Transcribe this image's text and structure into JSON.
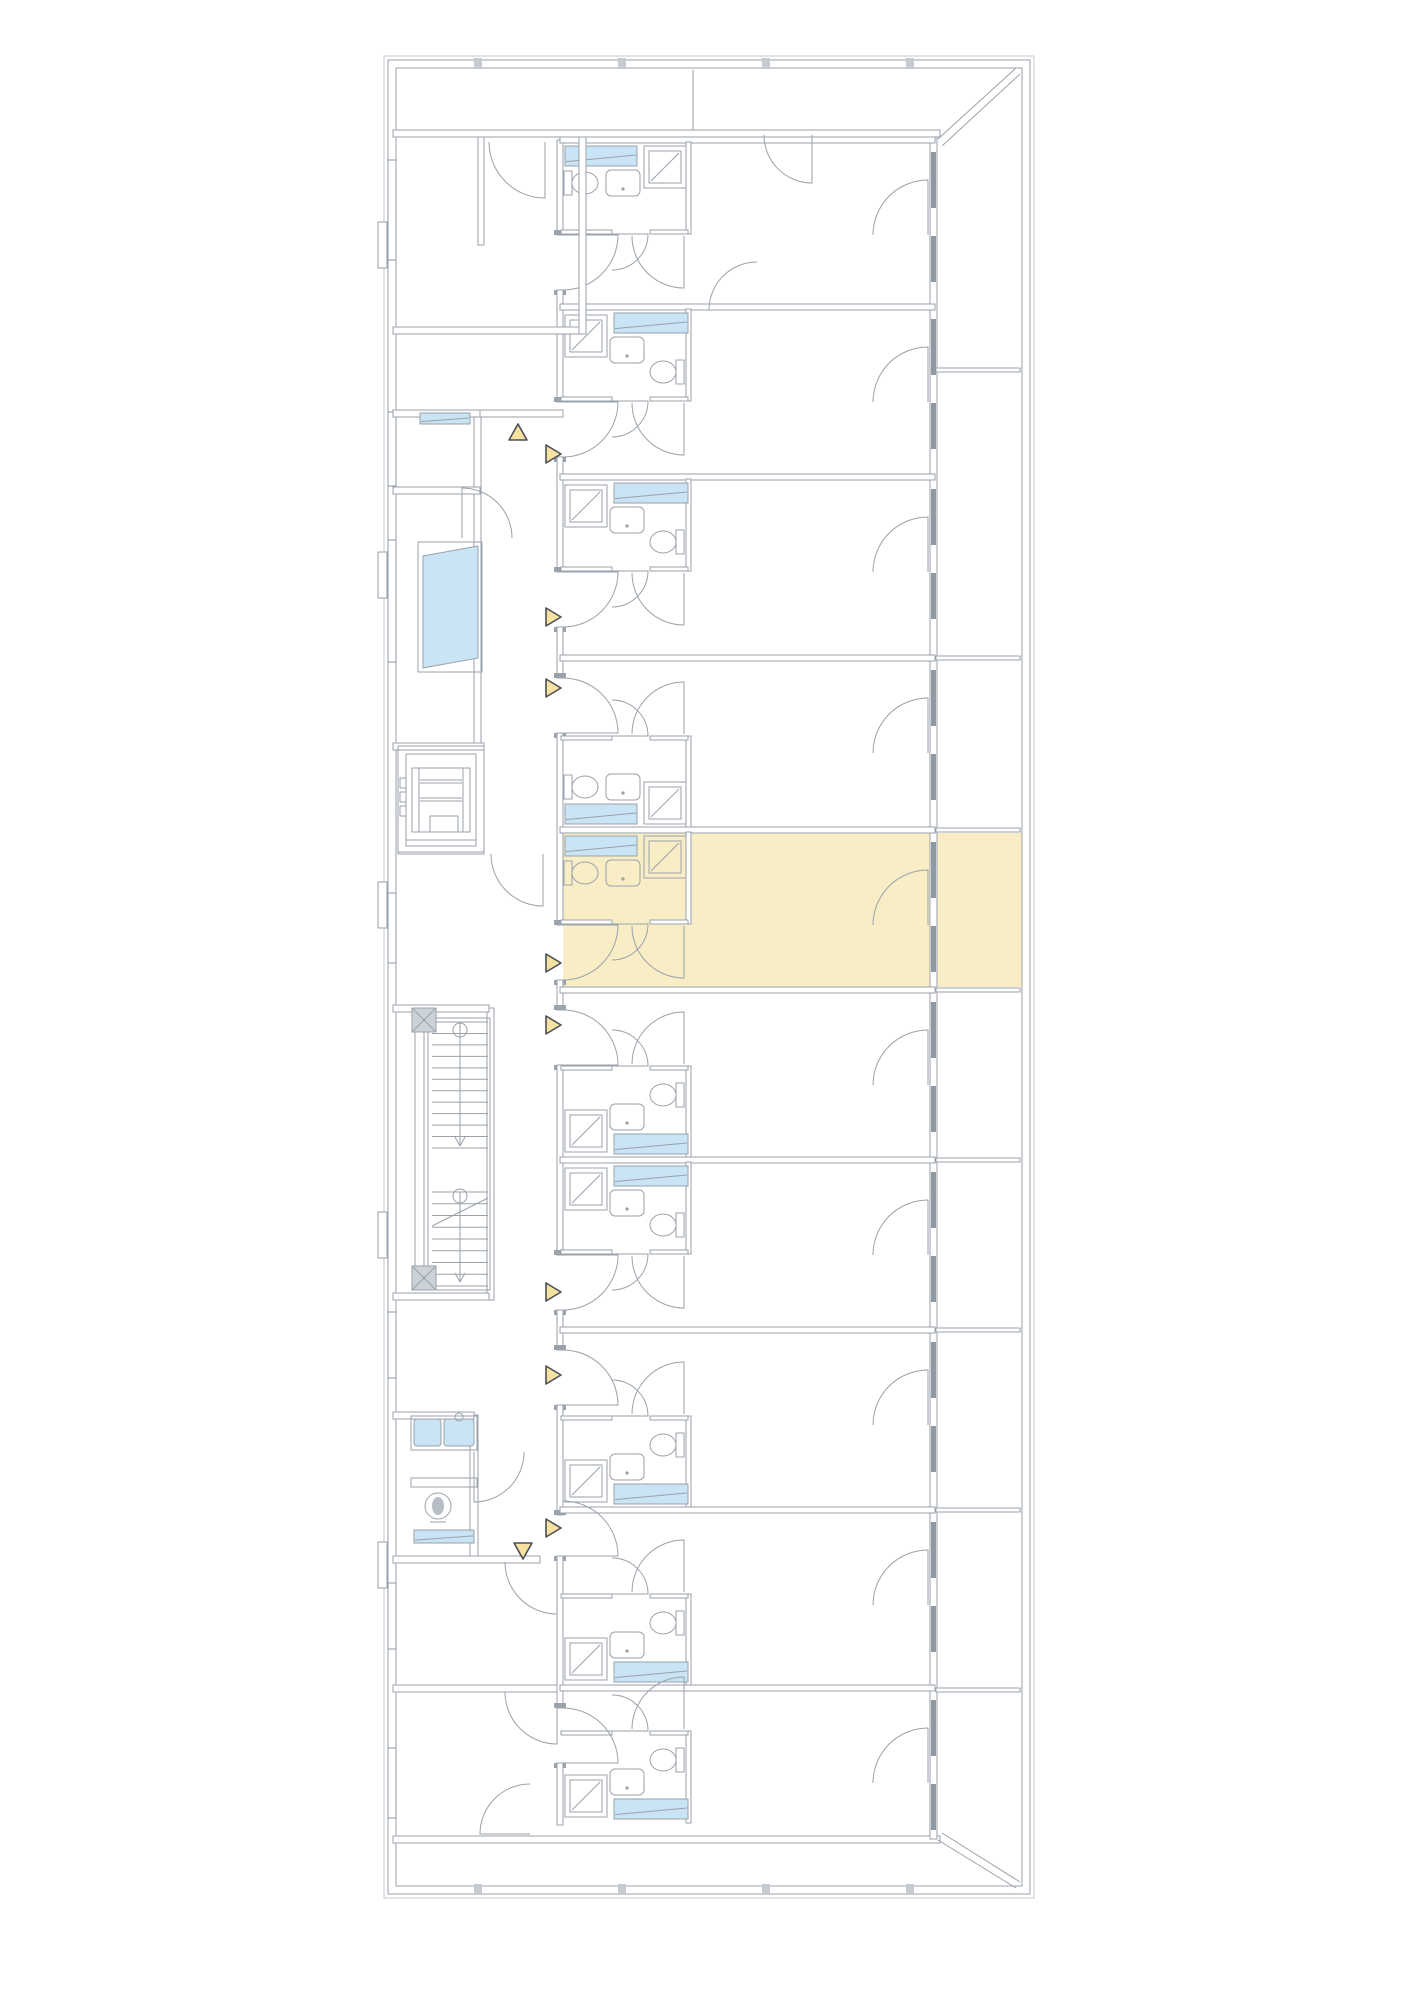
{
  "app": {
    "title": "floor-plan"
  },
  "palette": {
    "line": "#9aa2ab",
    "line_light": "#c6cbd1",
    "glazing": "#8f99a4",
    "highlight_fill": "#f9edc6",
    "water_blue": "#c9e4f4",
    "marker_fill": "#f5e1a0",
    "marker_stroke": "#4b4f57",
    "hatch_fill": "#cdd2d8",
    "background": "#ffffff"
  },
  "plan": {
    "width": 1414,
    "height": 2000,
    "shell": {
      "outer2": [
        384,
        56,
        650,
        1842
      ],
      "outer": [
        388,
        60,
        642,
        1834
      ],
      "inner": [
        396,
        68,
        626,
        1818
      ]
    },
    "bands": {
      "top_wall": [
        393,
        130,
        547,
        7
      ],
      "bottom_wall": [
        393,
        1836,
        547,
        7
      ],
      "right_wall": [
        930,
        137,
        7,
        1702
      ],
      "diag_tr": [
        [
          938,
          139,
          1016,
          68
        ],
        [
          942,
          146,
          1020,
          74
        ]
      ],
      "diag_br": [
        [
          938,
          1840,
          1016,
          1888
        ],
        [
          942,
          1833,
          1020,
          1882
        ]
      ],
      "top_divider_x": 693,
      "balcony_dividers_y": [
        370,
        658,
        830,
        990,
        1160,
        1330,
        1510,
        1690
      ],
      "ticks_top_x": [
        478,
        622,
        766,
        910
      ],
      "ticks_bottom_x": [
        478,
        622,
        766,
        910
      ]
    },
    "corridor": {
      "right_wall_x": 557,
      "right_wall_w": 6,
      "y_top": 140,
      "y_bottom": 1825,
      "left_segments": [
        [
          474,
          417,
          7,
          331
        ],
        [
          487,
          1008,
          7,
          292
        ],
        [
          470,
          1415,
          8,
          143
        ],
        [
          480,
          410,
          83,
          7
        ],
        [
          480,
          1556,
          60,
          7
        ]
      ]
    },
    "units": [
      {
        "y0": 140,
        "y1": 307,
        "bath": "top",
        "shower": "right"
      },
      {
        "y0": 307,
        "y1": 477,
        "bath": "top",
        "shower": "left"
      },
      {
        "y0": 477,
        "y1": 658,
        "bath": "top",
        "shower": "left"
      },
      {
        "y0": 658,
        "y1": 830,
        "bath": "bottom",
        "shower": "right"
      },
      {
        "y0": 830,
        "y1": 990,
        "bath": "top",
        "shower": "right",
        "highlight": true
      },
      {
        "y0": 990,
        "y1": 1160,
        "bath": "bottom",
        "shower": "left"
      },
      {
        "y0": 1160,
        "y1": 1330,
        "bath": "top",
        "shower": "left"
      },
      {
        "y0": 1330,
        "y1": 1510,
        "bath": "bottom",
        "shower": "left"
      },
      {
        "y0": 1510,
        "y1": 1688,
        "bath": "bottom",
        "shower": "left",
        "gap": [
          1515,
          1556
        ]
      },
      {
        "y0": 1688,
        "y1": 1825,
        "bath": "bottom",
        "shower": "left"
      }
    ],
    "highlight": {
      "rects": [
        [
          563,
          833,
          370,
          154
        ],
        [
          936,
          833,
          86,
          154
        ]
      ]
    },
    "left_walls": [
      [
        393,
        327,
        192,
        7
      ],
      [
        579,
        137,
        7,
        197
      ],
      [
        478,
        137,
        6,
        108
      ],
      [
        393,
        410,
        87,
        7
      ],
      [
        393,
        487,
        87,
        7
      ],
      [
        393,
        743,
        91,
        7
      ],
      [
        393,
        1005,
        96,
        7
      ],
      [
        393,
        1293,
        96,
        7
      ],
      [
        393,
        1412,
        81,
        7
      ],
      [
        393,
        1556,
        147,
        7
      ],
      [
        393,
        1685,
        164,
        7
      ]
    ],
    "left_doors": [
      {
        "hx": 545,
        "hy": 142,
        "r": 56,
        "a0": 90,
        "a1": 180
      },
      {
        "hx": 757,
        "hy": 310,
        "r": 48,
        "a0": 180,
        "a1": 270
      },
      {
        "hx": 462,
        "hy": 538,
        "r": 50,
        "a0": -90,
        "a1": 0
      },
      {
        "hx": 543,
        "hy": 854,
        "r": 52,
        "a0": 90,
        "a1": 180
      },
      {
        "hx": 474,
        "hy": 1452,
        "r": 50,
        "a0": 90,
        "a1": 0
      },
      {
        "hx": 557,
        "hy": 1562,
        "r": 52,
        "a0": 90,
        "a1": 180
      },
      {
        "hx": 557,
        "hy": 1692,
        "r": 52,
        "a0": 90,
        "a1": 180
      },
      {
        "hx": 530,
        "hy": 1834,
        "r": 50,
        "a0": 180,
        "a1": 270
      },
      {
        "hx": 812,
        "hy": 135,
        "r": 48,
        "a0": 90,
        "a1": 180
      }
    ],
    "left_blues": [
      {
        "rect": [
          420,
          413,
          50,
          11
        ]
      },
      {
        "poly": [
          [
            423,
            556
          ],
          [
            478,
            546
          ],
          [
            478,
            658
          ],
          [
            423,
            668
          ]
        ],
        "frame": [
          418,
          542,
          64,
          130
        ]
      }
    ],
    "left_windows": [
      [
        160,
        100
      ],
      [
        412,
        74
      ],
      [
        540,
        122
      ],
      [
        893,
        70
      ],
      [
        1312,
        66
      ],
      [
        1583,
        66
      ],
      [
        1748,
        70
      ]
    ],
    "pilasters": [
      [
        378,
        222
      ],
      [
        378,
        552
      ],
      [
        378,
        882
      ],
      [
        378,
        1212
      ],
      [
        378,
        1542
      ]
    ],
    "stairs": {
      "box": [
        428,
        1018,
        62,
        272
      ],
      "rail": [
        415,
        1020,
        9,
        268
      ],
      "flights": [
        {
          "a": 1022,
          "b": 1148,
          "n": 12
        },
        {
          "a": 1192,
          "b": 1286,
          "n": 9
        }
      ],
      "center_x": 460,
      "circles": [
        [
          460,
          1030
        ],
        [
          460,
          1196
        ]
      ],
      "arrows": [
        [
          460,
          1146
        ],
        [
          460,
          1282
        ]
      ],
      "hatches": [
        [
          412,
          1008
        ],
        [
          412,
          1266
        ]
      ],
      "diag": [
        432,
        1226,
        488,
        1198
      ]
    },
    "elevator": {
      "x": 398,
      "y": 746,
      "w": 86,
      "h": 108
    },
    "wc": {
      "room": [
        393,
        1419,
        84,
        137
      ],
      "counter": [
        411,
        1416,
        66,
        34
      ],
      "basins": [
        [
          414,
          1419,
          27,
          27
        ],
        [
          444,
          1419,
          30,
          27
        ]
      ],
      "faucet": [
        459,
        1417
      ],
      "toilet": [
        438,
        1506,
        13
      ],
      "shelf": [
        411,
        1478,
        66,
        9
      ],
      "sill": [
        414,
        1530,
        60,
        13
      ]
    },
    "markers": [
      {
        "x": 546,
        "y": 454,
        "d": "r"
      },
      {
        "x": 546,
        "y": 617,
        "d": "r"
      },
      {
        "x": 546,
        "y": 688,
        "d": "r"
      },
      {
        "x": 546,
        "y": 963,
        "d": "r"
      },
      {
        "x": 546,
        "y": 1025,
        "d": "r"
      },
      {
        "x": 546,
        "y": 1292,
        "d": "r"
      },
      {
        "x": 546,
        "y": 1375,
        "d": "r"
      },
      {
        "x": 546,
        "y": 1528,
        "d": "r"
      },
      {
        "x": 518,
        "y": 433,
        "d": "u"
      },
      {
        "x": 523,
        "y": 1550,
        "d": "d"
      }
    ]
  }
}
